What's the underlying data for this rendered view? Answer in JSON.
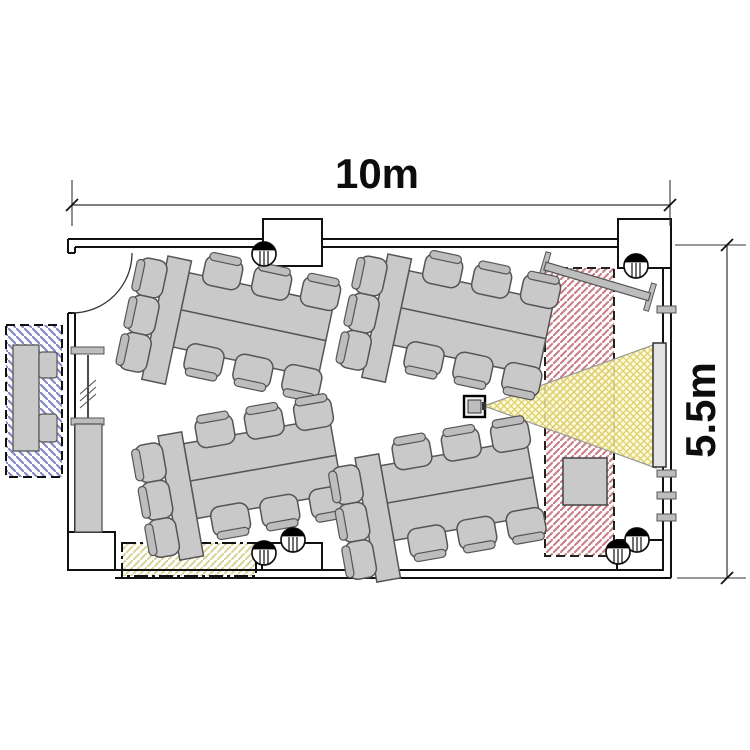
{
  "meta": {
    "drawing_type": "room floor plan"
  },
  "dimension_labels": {
    "width": "10m",
    "height": "5.5m"
  },
  "colors": {
    "wall": "#111111",
    "dim_line": "#333333",
    "furniture_fill": "#c9c9c9",
    "furniture_back": "#bdbdbd",
    "furniture_stroke": "#555555",
    "gray_fill": "#bdbdbd",
    "red_zone": "#ca8089",
    "blue_zone": "#8789c4",
    "floor_zone": "#d8d394",
    "beam_bg": "#fcf9d0",
    "beam_line": "#dcd06a",
    "screen_fill": "#e3e3e3"
  },
  "layout": {
    "walls": [
      [
        [
          68,
          239
        ],
        [
          618,
          239
        ]
      ],
      [
        [
          75,
          247
        ],
        [
          618,
          247
        ]
      ],
      [
        [
          68,
          239
        ],
        [
          68,
          253
        ]
      ],
      [
        [
          75,
          247
        ],
        [
          75,
          253
        ]
      ],
      [
        [
          68,
          253
        ],
        [
          75,
          253
        ]
      ],
      [
        [
          68,
          313
        ],
        [
          75,
          313
        ]
      ],
      [
        [
          68,
          313
        ],
        [
          68,
          532
        ]
      ],
      [
        [
          75,
          313
        ],
        [
          75,
          532
        ]
      ],
      [
        [
          115,
          570
        ],
        [
          663,
          570
        ]
      ],
      [
        [
          115,
          578
        ],
        [
          671,
          578
        ]
      ],
      [
        [
          663,
          268
        ],
        [
          663,
          570
        ]
      ],
      [
        [
          671,
          268
        ],
        [
          671,
          578
        ]
      ]
    ],
    "niches": [
      [
        263,
        219,
        59,
        47
      ],
      [
        618,
        219,
        53,
        49
      ],
      [
        262,
        543,
        60,
        27
      ],
      [
        617,
        540,
        46,
        30
      ],
      [
        68,
        532,
        47,
        38
      ]
    ],
    "zones": {
      "blue": [
        6,
        325,
        56,
        152
      ],
      "red": [
        545,
        268,
        69,
        288
      ],
      "floor": [
        122,
        543,
        134,
        33
      ]
    },
    "door": {
      "arc": "M132,253 A60,60 0 0 1 72,313"
    },
    "glazing": {
      "line": [
        88,
        355,
        88,
        418
      ],
      "ticks": [
        [
          80,
          394,
          96,
          380
        ],
        [
          80,
          401,
          96,
          387
        ],
        [
          80,
          408,
          96,
          394
        ]
      ],
      "caps": [
        [
          71,
          347,
          33,
          7
        ],
        [
          71,
          418,
          33,
          7
        ]
      ],
      "column": [
        75,
        424,
        27,
        108
      ]
    },
    "right_wall_caps": [
      [
        657,
        306,
        19,
        7
      ],
      [
        657,
        470,
        19,
        7
      ],
      [
        657,
        492,
        19,
        7
      ],
      [
        657,
        514,
        19,
        7
      ]
    ],
    "screen": [
      653,
      343,
      13,
      124
    ],
    "beam": [
      [
        484,
        406
      ],
      [
        656,
        344
      ],
      [
        656,
        468
      ]
    ],
    "projector": {
      "outer": [
        464,
        396,
        21,
        21
      ],
      "inner": [
        468,
        400,
        13,
        13
      ],
      "nub": [
        482,
        402,
        4,
        8
      ]
    },
    "cabinet": [
      563,
      458,
      44,
      47
    ],
    "whiteboard": {
      "x": 545,
      "y": 266,
      "angle": 16.5,
      "len": 109
    },
    "side_table": {
      "body": [
        13,
        345,
        26,
        106
      ],
      "chairs": [
        [
          39,
          352,
          18,
          26
        ],
        [
          39,
          414,
          18,
          28
        ]
      ]
    },
    "tables": [
      {
        "x": 168,
        "y": 256,
        "a": 12
      },
      {
        "x": 388,
        "y": 254,
        "a": 12
      },
      {
        "x": 158,
        "y": 436,
        "a": -10
      },
      {
        "x": 355,
        "y": 458,
        "a": -10
      }
    ],
    "markers": [
      [
        264,
        254
      ],
      [
        636,
        266
      ],
      [
        293,
        540
      ],
      [
        264,
        553
      ],
      [
        637,
        540
      ],
      [
        618,
        552
      ]
    ],
    "dims": {
      "top": {
        "line": [
          72,
          205,
          670,
          205
        ],
        "ext": [
          [
            72,
            180,
            72,
            226
          ],
          [
            670,
            180,
            670,
            226
          ]
        ],
        "ticks": [
          [
            66,
            211,
            78,
            199
          ],
          [
            664,
            211,
            676,
            199
          ]
        ]
      },
      "right": {
        "line": [
          727,
          245,
          727,
          578
        ],
        "ext": [
          [
            675,
            245,
            746,
            245
          ],
          [
            677,
            578,
            746,
            578
          ]
        ],
        "ticks": [
          [
            721,
            251,
            733,
            239
          ],
          [
            721,
            584,
            733,
            572
          ]
        ]
      }
    }
  }
}
